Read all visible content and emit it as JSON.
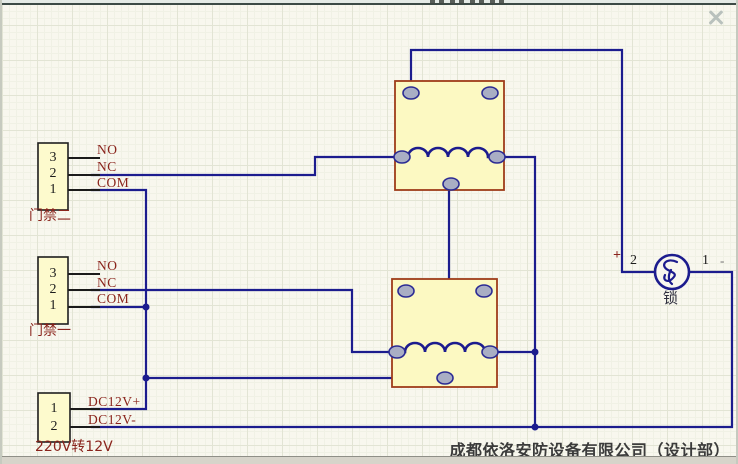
{
  "connectors": {
    "door2": {
      "label": "门禁二",
      "pins": [
        "3",
        "2",
        "1"
      ],
      "signals": [
        "NO",
        "NC",
        "COM"
      ]
    },
    "door1": {
      "label": "门禁一",
      "pins": [
        "3",
        "2",
        "1"
      ],
      "signals": [
        "NO",
        "NC",
        "COM"
      ]
    },
    "psu": {
      "label": "220V转12V",
      "pins": [
        "1",
        "2"
      ],
      "signals": [
        "DC12V+",
        "DC12V-"
      ]
    }
  },
  "lock": {
    "label": "锁",
    "polarity_plus": "+",
    "terminal_left": "2",
    "terminal_right": "1",
    "polarity_minus": "-"
  },
  "footer": {
    "company": "成都依洛安防设备有限公司（设计部）"
  },
  "colors": {
    "wire": "#1c1c8e",
    "signal_label": "#8a241c",
    "component_fill": "#fcf9c2",
    "connector_fill": "#fdfacd",
    "relay_border": "#9e3c1a",
    "pad_fill": "#a9aec4",
    "canvas_background": "#f8f7ee"
  }
}
